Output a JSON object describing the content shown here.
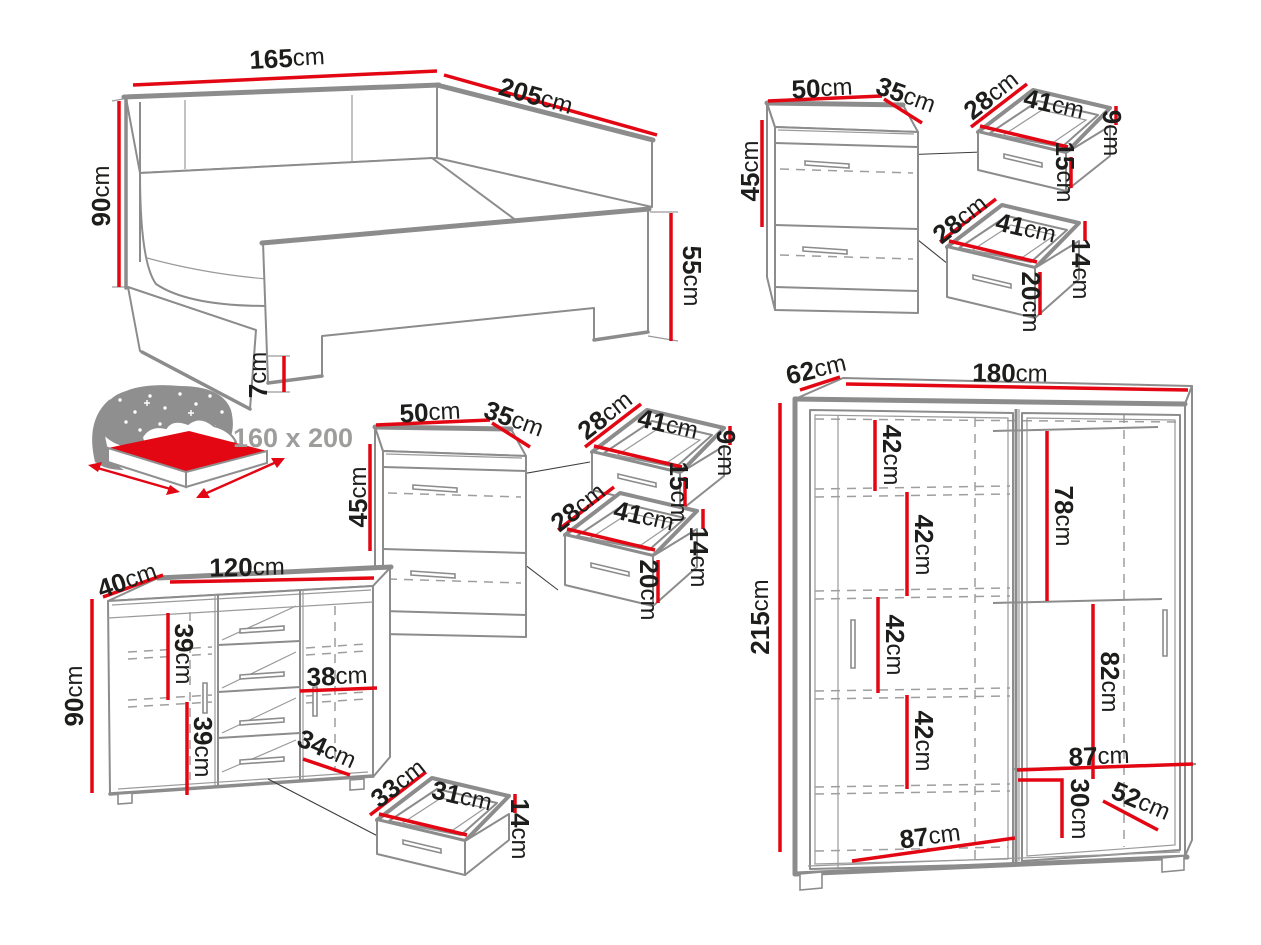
{
  "unit": "cm",
  "colors": {
    "dimension": "#e30613",
    "outline": "#8c8c8c",
    "text": "#1d1d1b",
    "muted": "#9d9d9c"
  },
  "bed": {
    "width": "165",
    "length": "205",
    "headboard_height": "90",
    "footboard_height": "55",
    "leg_height": "7",
    "mattress_size": "160 x 200"
  },
  "nightstand_top": {
    "width": "50",
    "depth": "35",
    "height": "45",
    "drawer_small": {
      "depth": "28",
      "width": "41",
      "back_height": "9",
      "front_height": "15"
    },
    "drawer_large": {
      "depth": "28",
      "width": "41",
      "back_height": "14",
      "front_height": "20"
    }
  },
  "nightstand_middle": {
    "width": "50",
    "depth": "35",
    "height": "45",
    "drawer_small": {
      "depth": "28",
      "width": "41",
      "back_height": "9",
      "front_height": "15"
    },
    "drawer_large": {
      "depth": "28",
      "width": "41",
      "back_height": "14",
      "front_height": "20"
    }
  },
  "dresser": {
    "depth": "40",
    "width": "120",
    "height": "90",
    "upper_section": "39",
    "lower_section": "39",
    "right_section": "38",
    "drawer_front": "34",
    "drawer": {
      "depth": "33",
      "width": "31",
      "height": "14"
    }
  },
  "wardrobe": {
    "depth": "62",
    "width": "180",
    "height": "215",
    "shelf_gaps": [
      "42",
      "42",
      "42",
      "42"
    ],
    "right_upper": "78",
    "right_lower": "82",
    "right_width": "87",
    "shoe_height": "30",
    "shoe_depth": "52",
    "door_width": "87"
  }
}
